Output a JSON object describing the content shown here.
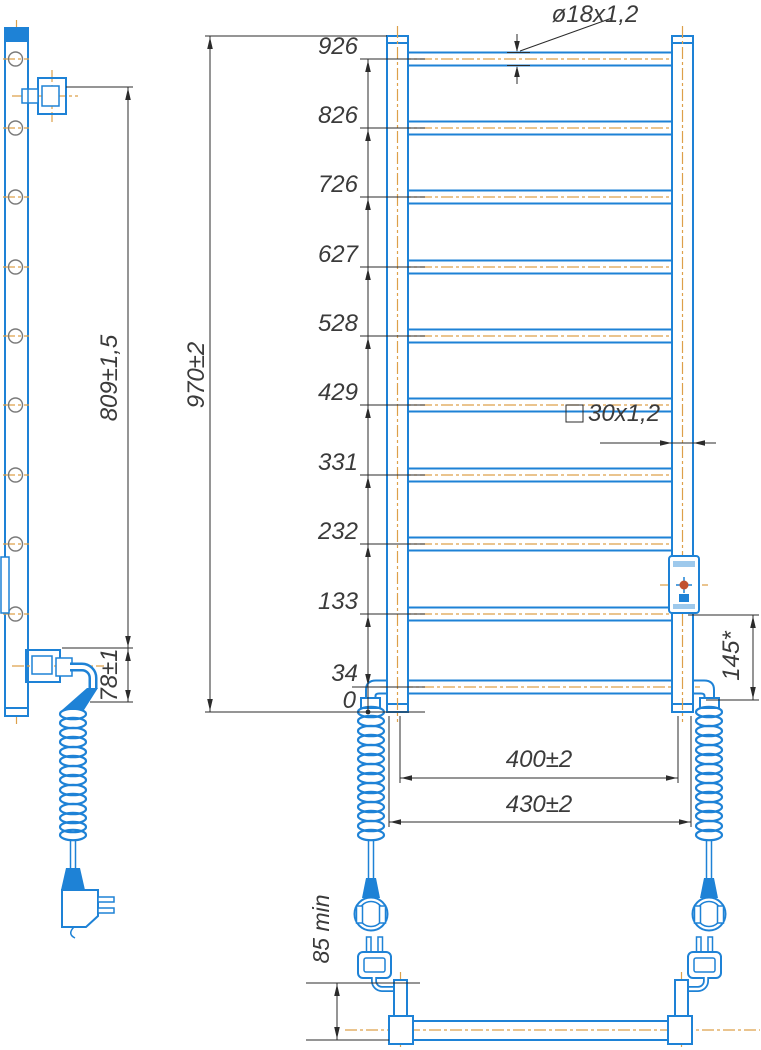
{
  "drawing": {
    "type": "technical-drawing",
    "subject": "electric heated towel rail ladder, front / side / bottom views",
    "colors": {
      "outline_blue": "#1e82d6",
      "centerline_orange": "#dda04a",
      "dimension_black": "#2b2b2b",
      "text_gray": "#3b3b3b",
      "indicator_dot": "#c2512f"
    },
    "front_view": {
      "rung_heights": [
        "926",
        "826",
        "726",
        "627",
        "528",
        "429",
        "331",
        "232",
        "133",
        "34",
        "0"
      ],
      "overall_height": "970±2",
      "tube_spec": "ø18x1,2",
      "post_spec": "30x1,2",
      "heater_bottom_ref": "145*",
      "inner_width": "400±2",
      "outer_width": "430±2"
    },
    "side_view": {
      "bracket_span": "809±1,5",
      "bracket_bottom_offset": "78±1"
    },
    "bottom_view": {
      "plug_clearance": "85 min"
    }
  }
}
